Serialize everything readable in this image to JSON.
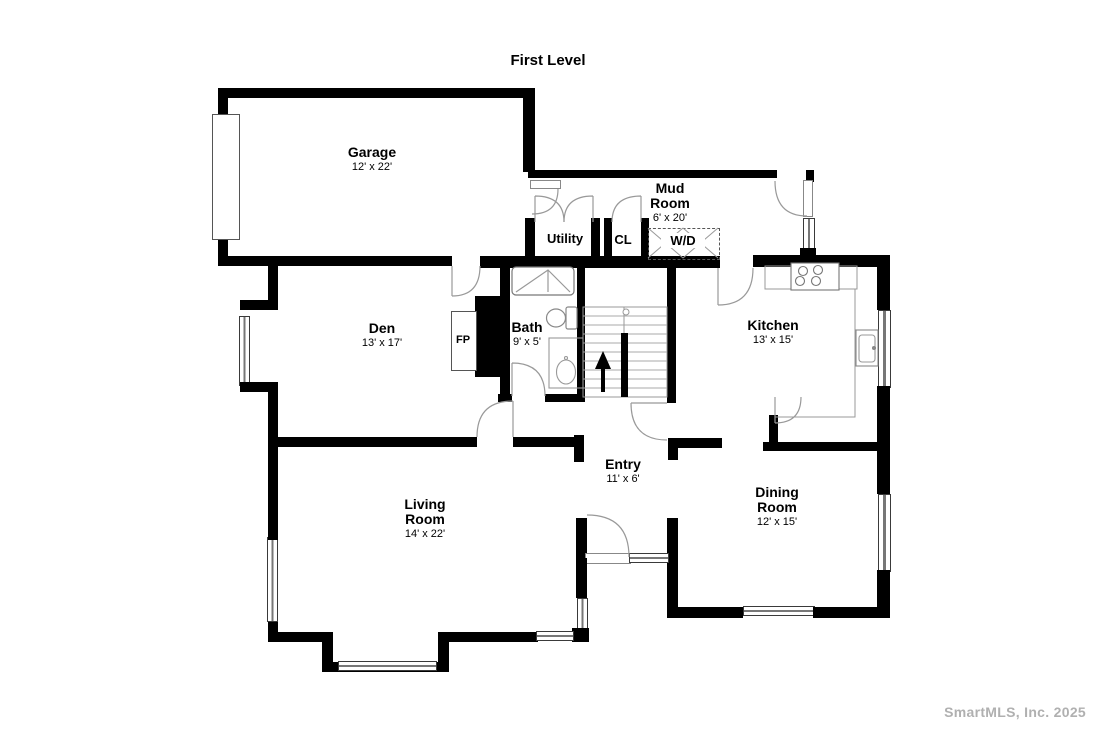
{
  "title": "First Level",
  "watermark": "SmartMLS, Inc.  2025",
  "rooms": [
    {
      "id": "garage",
      "name": "Garage",
      "dims": "12' x 22'"
    },
    {
      "id": "mud-room",
      "name": "Mud Room",
      "dims": "6' x 20'"
    },
    {
      "id": "utility",
      "name": "Utility",
      "dims": ""
    },
    {
      "id": "closet",
      "name": "CL",
      "dims": ""
    },
    {
      "id": "washer-dryer",
      "name": "W/D",
      "dims": ""
    },
    {
      "id": "den",
      "name": "Den",
      "dims": "13' x 17'"
    },
    {
      "id": "bath",
      "name": "Bath",
      "dims": "9' x 5'"
    },
    {
      "id": "kitchen",
      "name": "Kitchen",
      "dims": "13' x 15'"
    },
    {
      "id": "entry",
      "name": "Entry",
      "dims": "11' x 6'"
    },
    {
      "id": "living-room",
      "name": "Living Room",
      "dims": "14' x 22'"
    },
    {
      "id": "dining-room",
      "name": "Dining Room",
      "dims": "12' x 15'"
    },
    {
      "id": "fireplace",
      "name": "FP",
      "dims": ""
    }
  ],
  "colors": {
    "wall": "#000000",
    "door_arc": "#999999",
    "fixture_line": "#888888",
    "window_frame": "#3a3a3a",
    "watermark": "#b0b0b0"
  }
}
